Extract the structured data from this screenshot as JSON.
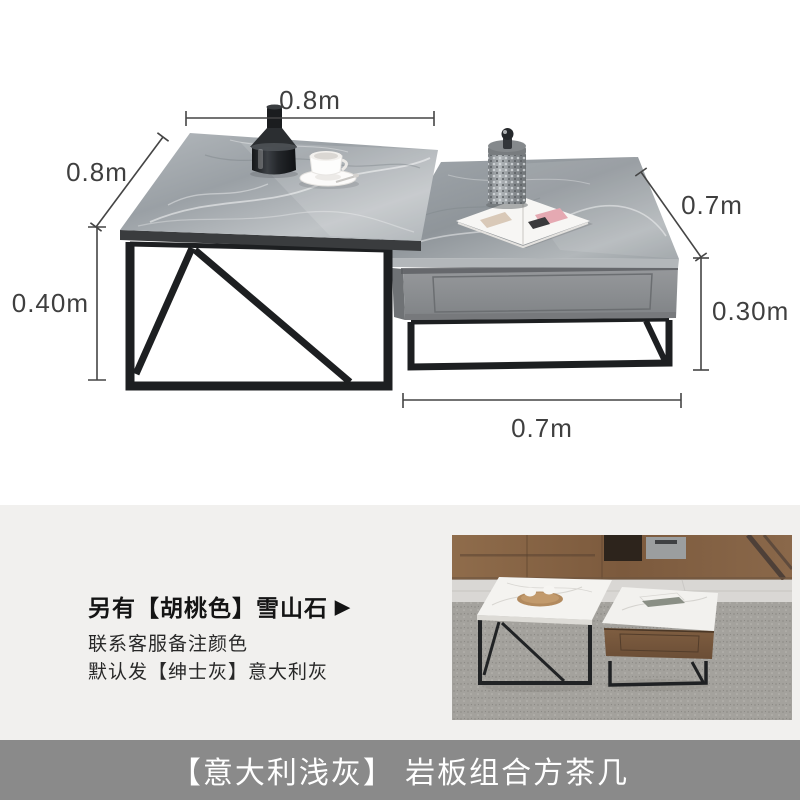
{
  "dimensions": {
    "top_width": "0.8m",
    "left_depth": "0.8m",
    "left_height": "0.40m",
    "right_depth": "0.7m",
    "right_height": "0.30m",
    "bottom_width": "0.7m"
  },
  "info": {
    "headline": "另有【胡桃色】雪山石",
    "arrow": "▶",
    "note1": "联系客服备注颜色",
    "note2": "默认发【绅士灰】意大利灰"
  },
  "banner": {
    "title": "【意大利浅灰】 岩板组合方茶几"
  },
  "colors": {
    "panel_bg": "#f1f0ee",
    "banner_bg": "#8a8a8a",
    "banner_text": "#ffffff",
    "dimension_ink": "#3f3f3f",
    "headline_ink": "#141414",
    "note_ink": "#282828",
    "marble_gray": "#9aa0a5",
    "frame_black": "#1d1f21",
    "drawer_gray": "#8a8d90"
  }
}
